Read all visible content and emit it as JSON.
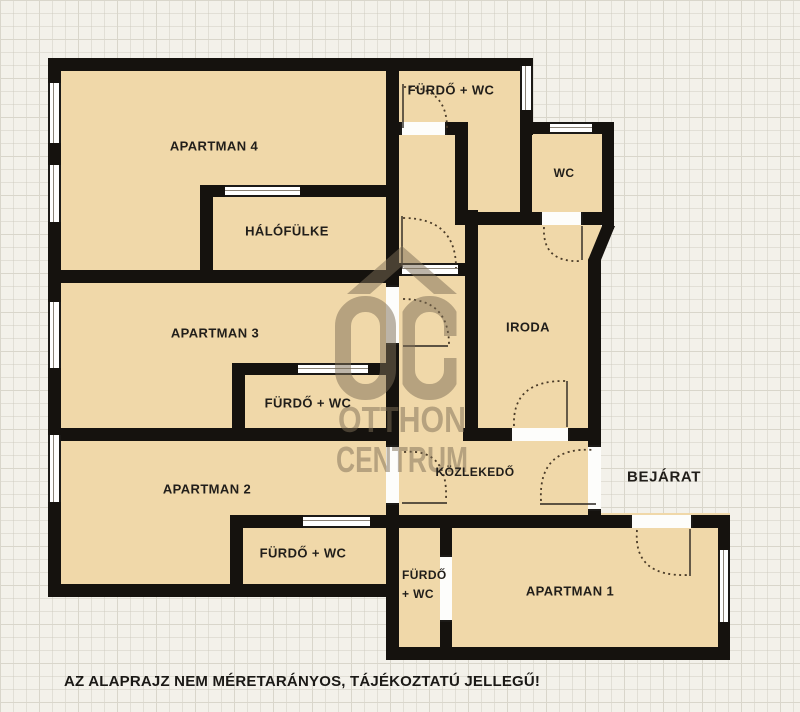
{
  "watermark": {
    "monogram": "OC",
    "line1": "OTTHON",
    "line2": "CENTRUM"
  },
  "rooms": {
    "apartman4": "APARTMAN 4",
    "halofulke": "HÁLÓFÜLKE",
    "furdo_wc_top": "FÜRDŐ + WC",
    "wc": "WC",
    "iroda": "IRODA",
    "apartman3": "APARTMAN 3",
    "furdo_wc_apartman3": "FÜRDŐ + WC",
    "apartman2": "APARTMAN 2",
    "furdo_wc_apartman2": "FÜRDŐ + WC",
    "kozlekedo": "KÖZLEKEDŐ",
    "bejarat": "BEJÁRAT",
    "furdo_wc_apartman1_line1": "FÜRDŐ",
    "furdo_wc_apartman1_line2": "+ WC",
    "apartman1": "APARTMAN 1"
  },
  "footer": {
    "disclaimer": "AZ ALAPRAJZ NEM MÉRETARÁNYOS, TÁJÉKOZTATÚ JELLEGŰ!"
  },
  "colors": {
    "wall": "#15120e",
    "room_fill": "#f0d8a9",
    "background": "#f3f1ea",
    "grid_line": "#d9d6cb",
    "watermark": "#7d6e56",
    "label_text": "#211e1a"
  }
}
